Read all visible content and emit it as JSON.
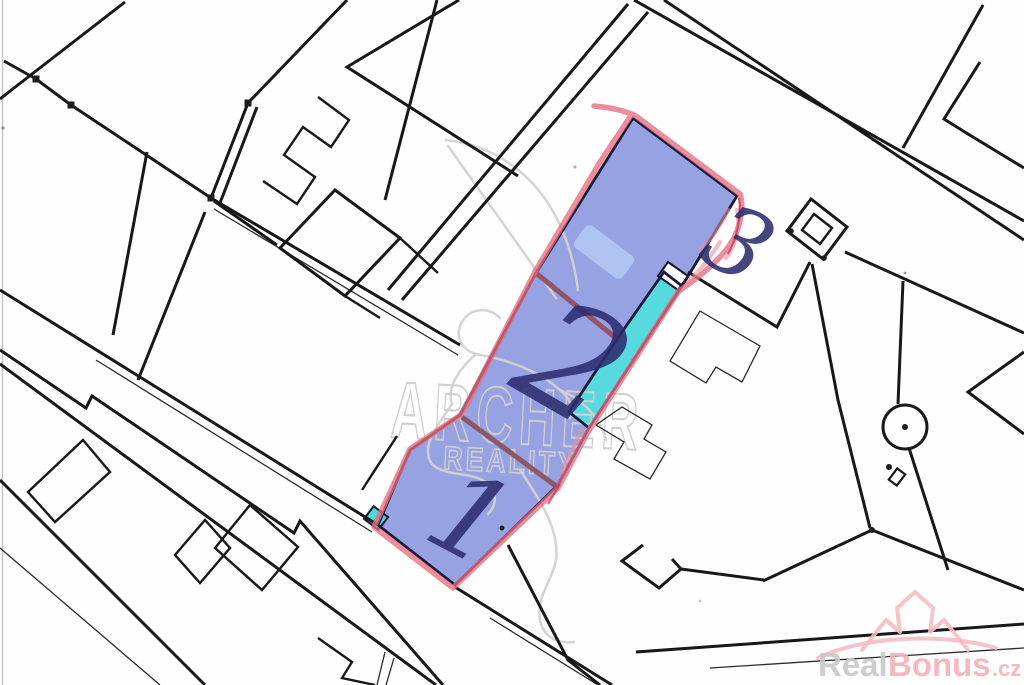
{
  "map": {
    "kind": "cadastral-plan-scan",
    "parcels": {
      "items": [
        {
          "label": "1"
        },
        {
          "label": "2"
        },
        {
          "label": "3"
        }
      ],
      "highlight_fill": "#8e9be0",
      "strip_fill": "#4ed7de",
      "outline_marker_color": "#e56d7e",
      "divider_color": "#8d4e5a",
      "handwriting_color": "#2d2d6e"
    },
    "symbols": [
      "boundary-marker-square",
      "monument-double-square",
      "well-circle",
      "survey-dot"
    ]
  },
  "watermark": {
    "line1": "ARCHER",
    "line2": "REALITY",
    "color": "#cfcfcf"
  },
  "logo": {
    "part1": "Real",
    "part2": "Bonus",
    "tld": ".cz",
    "gray": "#c8c8c8",
    "pink": "#f3b2b8"
  }
}
